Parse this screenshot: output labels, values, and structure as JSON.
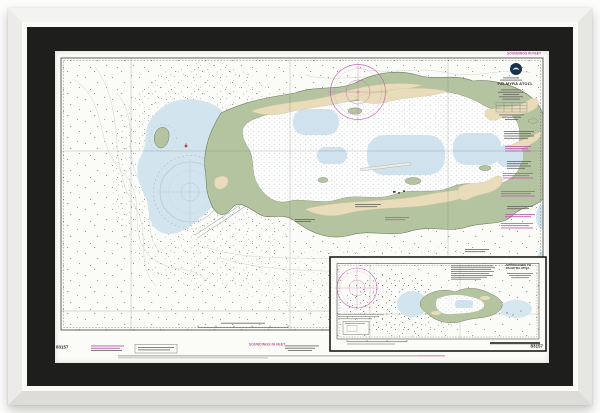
{
  "artwork": {
    "type": "framed-nautical-chart-print",
    "chart_number": "83157",
    "title": "PALMYRA ATOLL",
    "soundings_note": "SOUNDINGS IN FEET",
    "inset": {
      "title_line1": "APPROACHES TO",
      "title_line2": "PALMYRA ATOLL"
    },
    "logo": "noaa-logo"
  },
  "colors": {
    "frame_molding": "#ececea",
    "mat": "#1e1e1d",
    "paper": "#fbfbf8",
    "land": "#b5c4a0",
    "sand": "#e9dcba",
    "shallow_water": "#d2e4ee",
    "reef_stipple": "#7e8d96",
    "magenta": "#bb56a8",
    "neatline": "#3c3c3a"
  }
}
